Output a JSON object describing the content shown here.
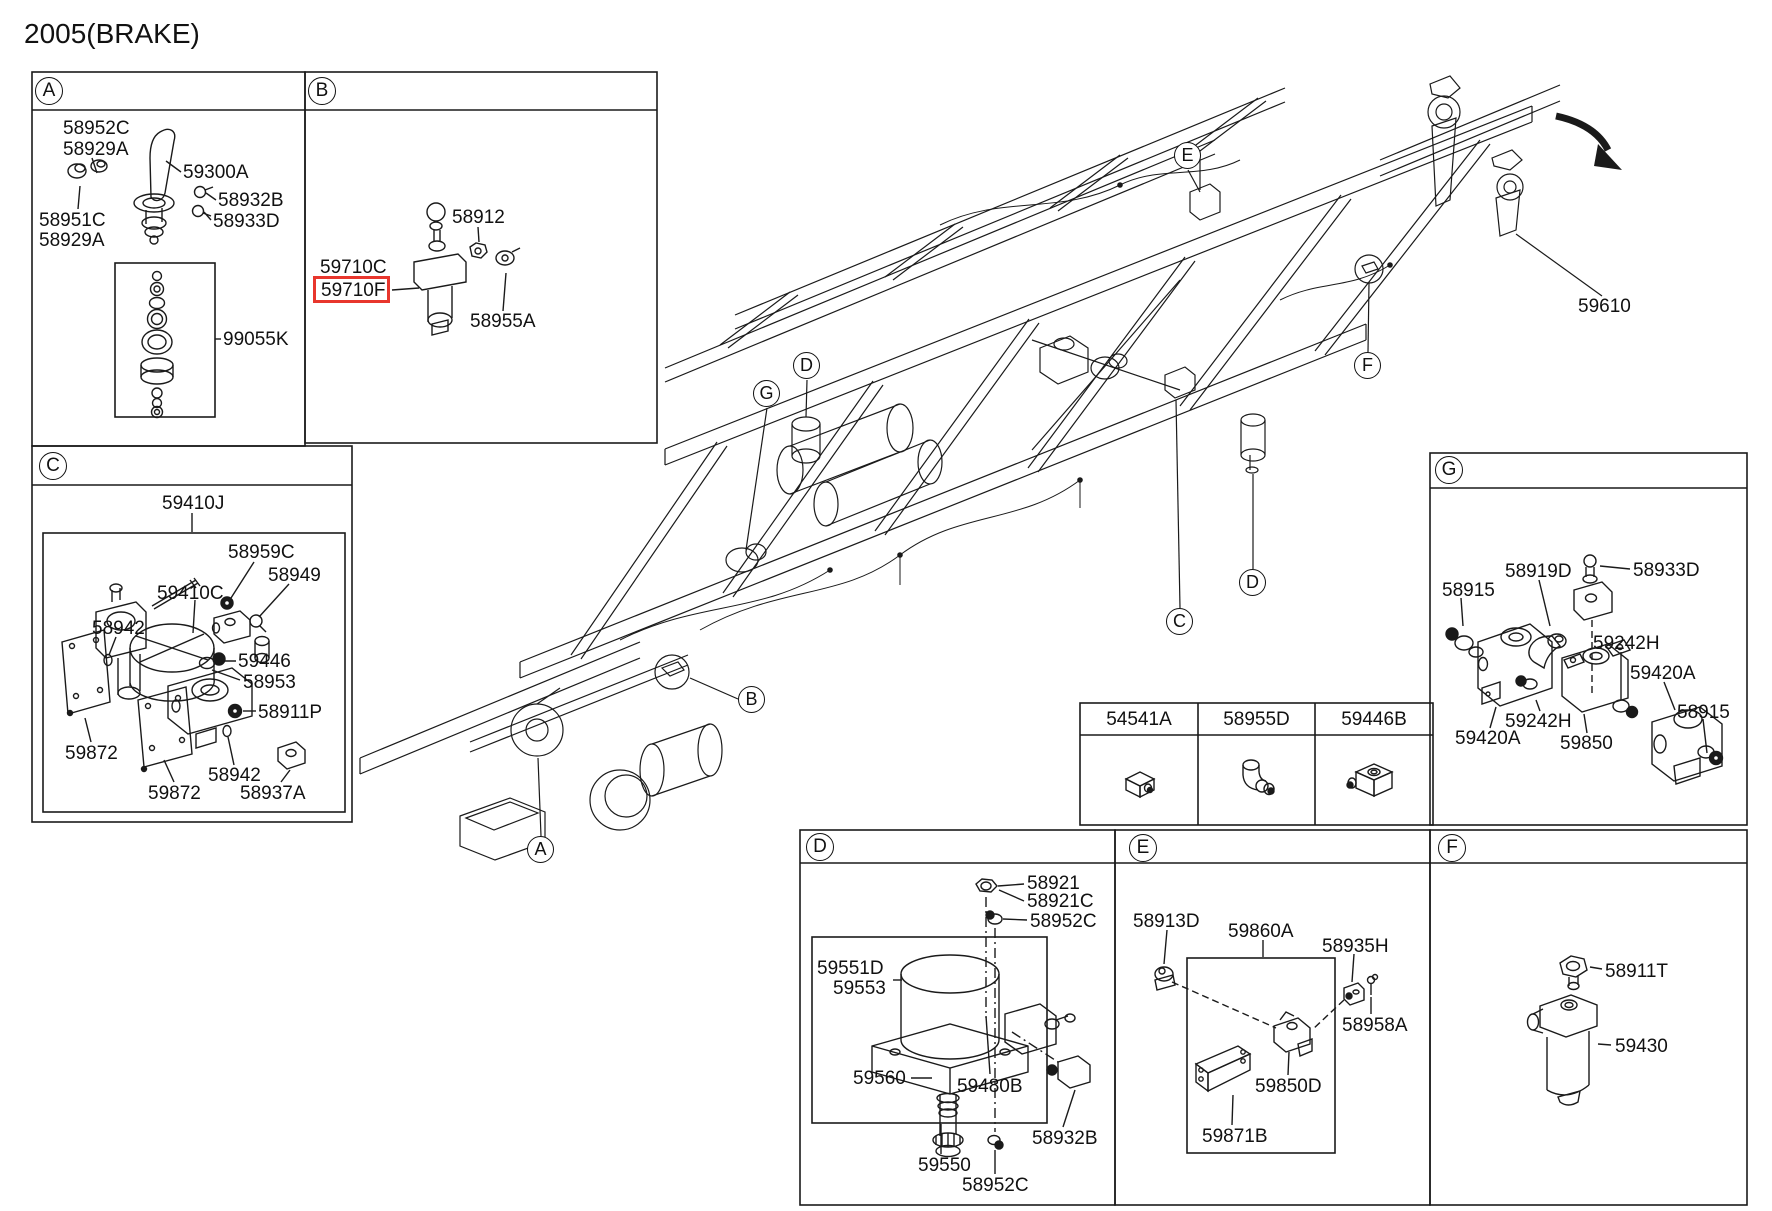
{
  "title": "2005(BRAKE)",
  "highlight": {
    "selected_part": "59710F",
    "color": "#e8362d"
  },
  "sections": {
    "A": {
      "letter": "A",
      "labels": [
        "58952C",
        "58929A",
        "59300A",
        "58932B",
        "58933D",
        "58951C",
        "58929A",
        "99055K"
      ]
    },
    "B": {
      "letter": "B",
      "labels": [
        "59710C",
        "59710F",
        "58912",
        "58955A"
      ]
    },
    "C": {
      "letter": "C",
      "labels": [
        "59410J",
        "58959C",
        "58949",
        "59410C",
        "58942",
        "59446",
        "58953",
        "58911P",
        "59872",
        "58942",
        "59872",
        "58937A"
      ]
    },
    "D": {
      "letter": "D",
      "labels": [
        "58921",
        "58921C",
        "58952C",
        "59551D",
        "59553",
        "59560",
        "59480B",
        "58932B",
        "59550",
        "58952C"
      ]
    },
    "E": {
      "letter": "E",
      "labels": [
        "58913D",
        "59860A",
        "58935H",
        "58958A",
        "59850D",
        "59871B"
      ]
    },
    "F": {
      "letter": "F",
      "labels": [
        "58911T",
        "59430"
      ]
    },
    "G": {
      "letter": "G",
      "labels": [
        "58919D",
        "58933D",
        "58915",
        "59242H",
        "59420A",
        "58915",
        "59242H",
        "59420A",
        "59850"
      ]
    }
  },
  "table": {
    "columns": [
      "54541A",
      "58955D",
      "59446B"
    ]
  },
  "chassis": {
    "callouts": [
      "A",
      "B",
      "C",
      "D",
      "D",
      "E",
      "F",
      "G"
    ],
    "part_label": "59610"
  }
}
